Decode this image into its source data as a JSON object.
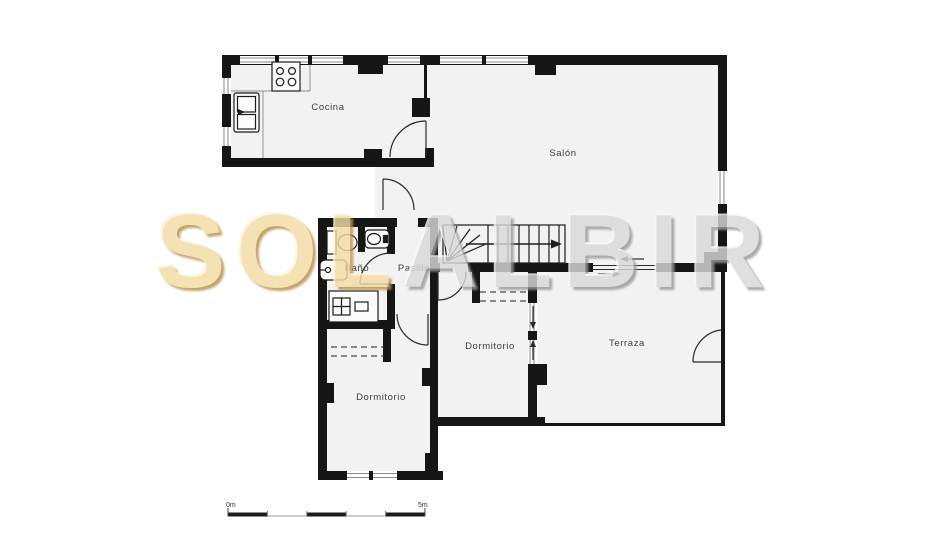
{
  "floorplan": {
    "watermark": {
      "left": "SOL",
      "right": "ALBIR"
    },
    "rooms": {
      "cocina": {
        "label": "Cocina"
      },
      "salon": {
        "label": "Salón"
      },
      "bano": {
        "label": "Baño"
      },
      "pasillo": {
        "label": "Pasillo"
      },
      "dormitorio_right": {
        "label": "Dormitorio"
      },
      "dormitorio_left": {
        "label": "Dormitorio"
      },
      "terraza": {
        "label": "Terraza"
      }
    },
    "scale_bar": {
      "start_label": "0m",
      "end_label": "5m"
    },
    "colors": {
      "wall": "#161616",
      "floor_fill": "#f2f2f2",
      "background": "#ffffff",
      "watermark_gold": "#f3dca4",
      "watermark_gray": "#d9d9d9"
    }
  }
}
